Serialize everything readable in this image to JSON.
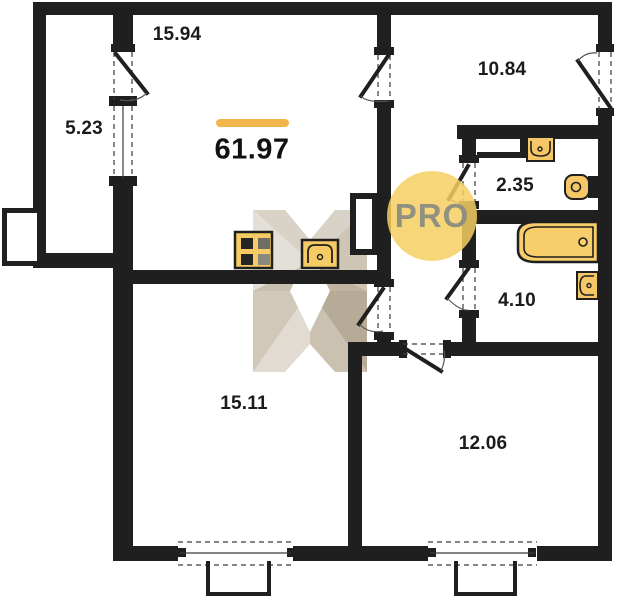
{
  "floor_plan": {
    "badge_text": "PRO",
    "total_area": "61.97",
    "rooms": [
      {
        "id": "kitchen-living-room",
        "area": "15.94"
      },
      {
        "id": "balcony",
        "area": "5.23"
      },
      {
        "id": "bedroom",
        "area": "10.84"
      },
      {
        "id": "wc",
        "area": "2.35"
      },
      {
        "id": "bathroom",
        "area": "4.10"
      },
      {
        "id": "room-bottom-left",
        "area": "15.11"
      },
      {
        "id": "room-bottom-right",
        "area": "12.06"
      }
    ],
    "colors": {
      "wall_black": "#1F1F1F",
      "fixture_yellow": "#F6CB63",
      "accent_bar_orange": "#F2B44C",
      "badge_yellow": "#F6CF62",
      "badge_text_gray": "#9A9A90",
      "watermark_beige": "#CFC6B6"
    }
  }
}
